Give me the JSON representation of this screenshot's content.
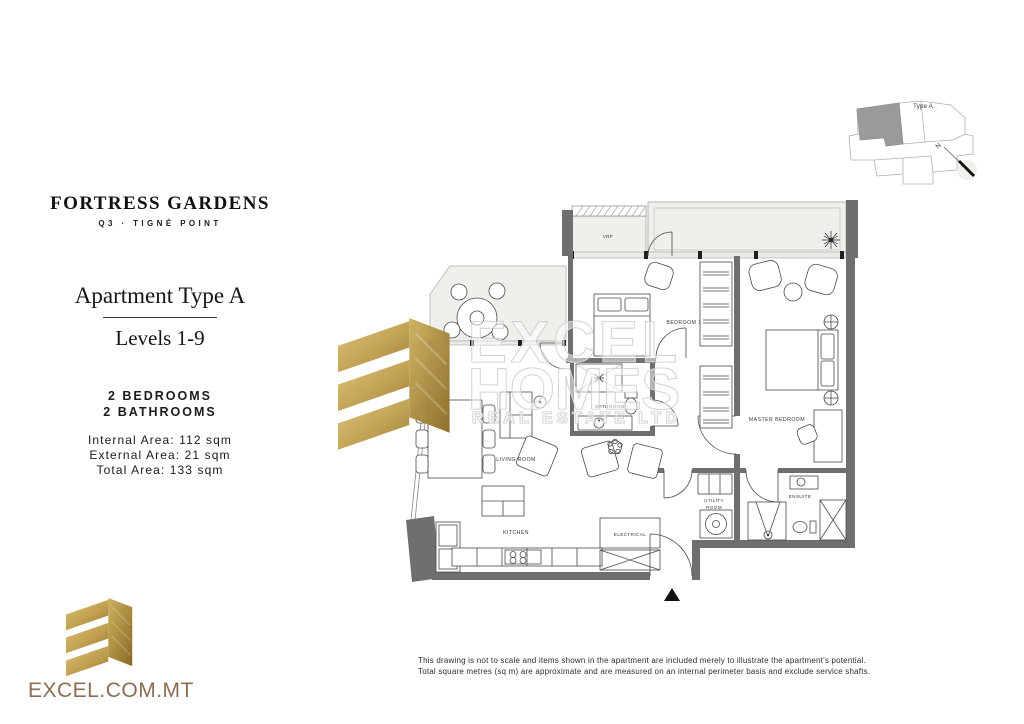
{
  "brand": {
    "project_name": "FORTRESS GARDENS",
    "project_location": "Q3 · TIGNÉ POINT",
    "website": "EXCEL.COM.MT",
    "watermark_line1": "EXCEL",
    "watermark_line2": "HOMES",
    "watermark_line3": "REAL ESTATE LTD"
  },
  "apartment": {
    "title": "Apartment Type A",
    "levels": "Levels 1-9",
    "bedrooms": "2 BEDROOMS",
    "bathrooms": "2 BATHROOMS",
    "internal_area": "Internal Area: 112 sqm",
    "external_area": "External Area: 21 sqm",
    "total_area": "Total Area: 133 sqm"
  },
  "floorplan": {
    "rooms": {
      "vrf": "VRF",
      "bedroom1": "BEDROOM 1",
      "master_bedroom": "MASTER BEDROOM",
      "bathroom": "BATHROOM",
      "living_room": "LIVING ROOM",
      "kitchen": "KITCHEN",
      "electrical": "ELECTRICAL",
      "utility_line1": "UTILITY",
      "utility_line2": "ROOM",
      "ensuite": "ENSUITE"
    }
  },
  "keyplan": {
    "unit_label": "Type A",
    "north_label": "N"
  },
  "disclaimer": {
    "line1": "This drawing is not to scale and items shown in the apartment are included merely to illustrate the apartment's potential.",
    "line2": "Total square metres (sq m) are approximate and are measured on an internal perimeter basis and exclude service shafts."
  },
  "colors": {
    "gold_light": "#dcc176",
    "gold_dark": "#99782f",
    "plan_wall": "#6f6f6f",
    "brand_text": "#8a6d52"
  }
}
